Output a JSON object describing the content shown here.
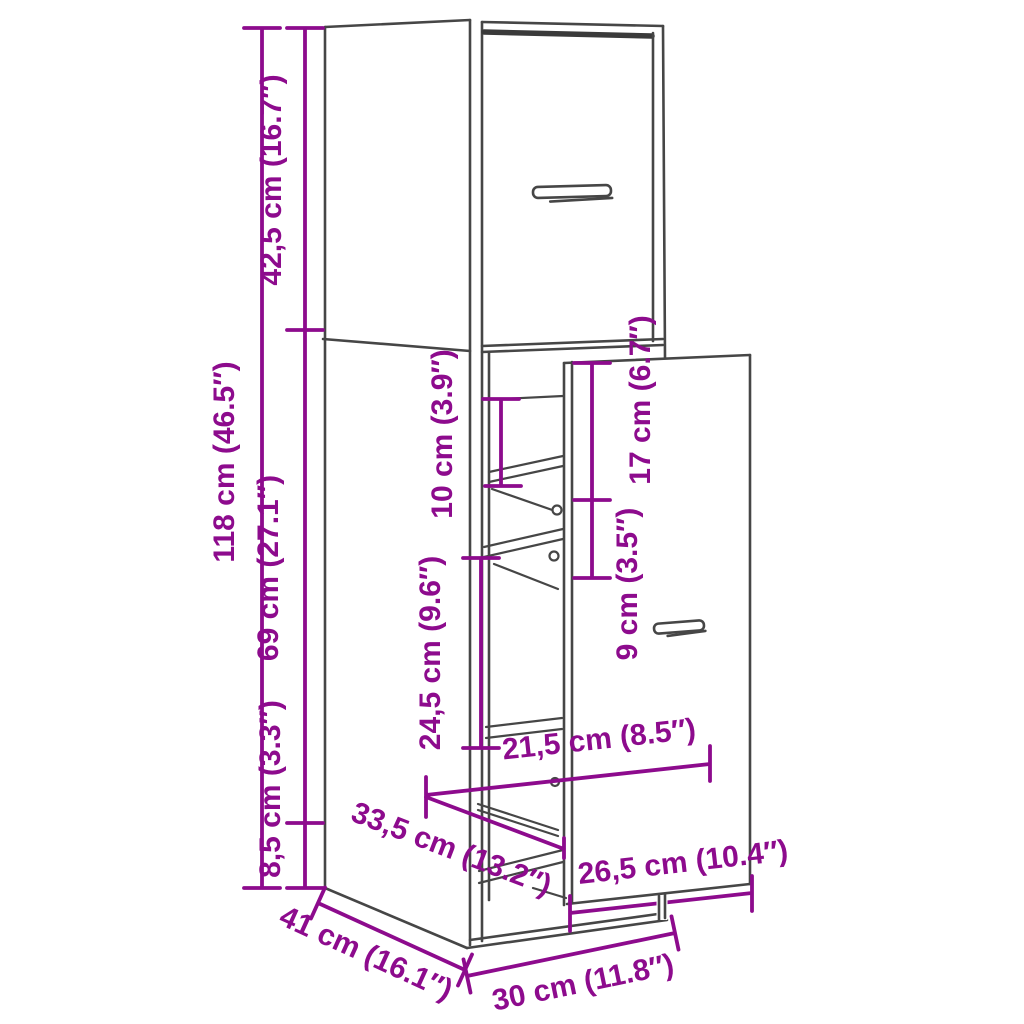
{
  "figure": {
    "type": "furniture-dimension-diagram",
    "subject": "tall narrow pull-out apothecary cabinet, line drawing with dimension arrows",
    "background_color": "#ffffff",
    "outline_color": "#464646",
    "dimension_color": "#8d0b8d"
  },
  "dimensions": {
    "height_total": {
      "label": "118 cm (46.5″)"
    },
    "height_top_drawer": {
      "label": "42,5 cm (16.7″)"
    },
    "height_lower": {
      "label": "69 cm (27.1″)"
    },
    "height_plinth": {
      "label": "8,5 cm (3.3″)"
    },
    "shelf_spacing": {
      "label": "10 cm (3.9″)"
    },
    "inner_upper": {
      "label": "17 cm (6.7″)"
    },
    "inner_small": {
      "label": "9 cm (3.5″)"
    },
    "inner_middle": {
      "label": "24,5 cm (9.6″)"
    },
    "inner_width": {
      "label": "21,5 cm (8.5″)"
    },
    "inner_depth": {
      "label": "33,5 cm (13.2″)"
    },
    "front_panel_width": {
      "label": "26,5 cm (10.4″)"
    },
    "cabinet_depth": {
      "label": "41 cm (16.1″)"
    },
    "cabinet_width": {
      "label": "30 cm (11.8″)"
    }
  }
}
